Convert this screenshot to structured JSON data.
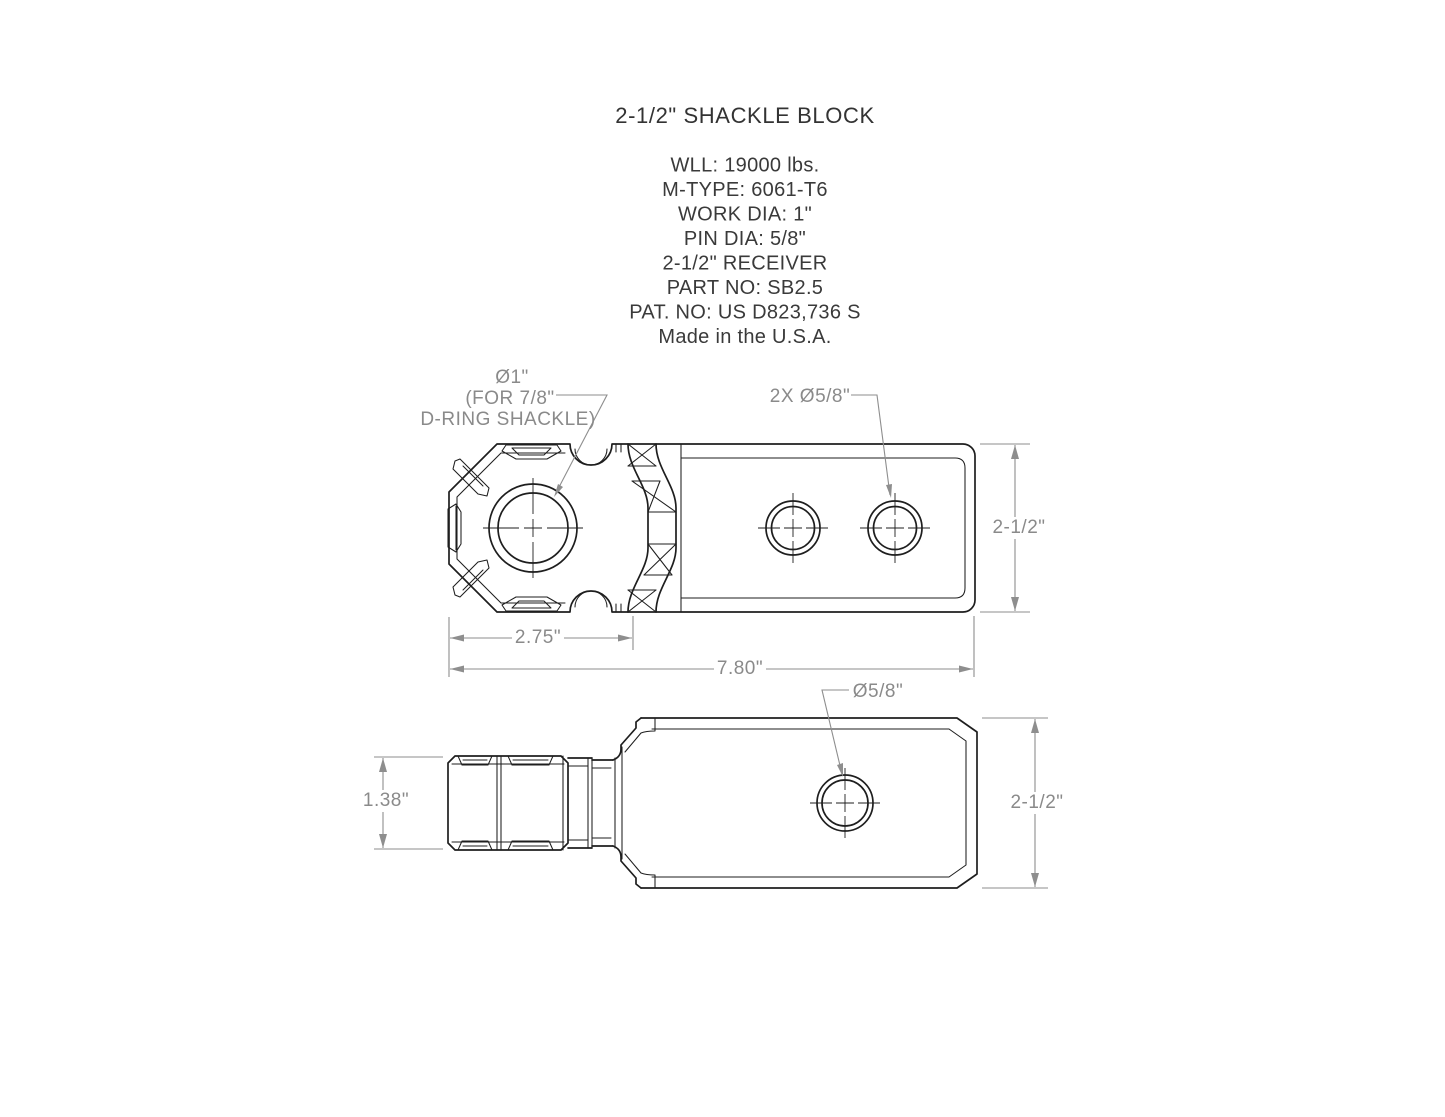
{
  "drawing": {
    "title": "2-1/2\" SHACKLE BLOCK",
    "specs": [
      "WLL: 19000 lbs.",
      "M-TYPE: 6061-T6",
      "WORK DIA: 1\"",
      "PIN DIA: 5/8\"",
      "2-1/2\" RECEIVER",
      "PART NO: SB2.5",
      "PAT. NO: US D823,736 S",
      "Made in the U.S.A."
    ]
  },
  "top_view": {
    "main_hole_label_line1": "Ø1\"",
    "main_hole_label_line2": "(FOR 7/8\"",
    "main_hole_label_line3": "D-RING SHACKLE)",
    "pin_holes_label": "2X Ø5/8\"",
    "dim_head_width": "2.75\"",
    "dim_overall_length": "7.80\"",
    "dim_height": "2-1/2\""
  },
  "side_view": {
    "pin_hole_label": "Ø5/8\"",
    "dim_head_thickness": "1.38\"",
    "dim_height": "2-1/2\""
  },
  "colors": {
    "line": "#1e1e1e",
    "dimension": "#8e8e8e",
    "text": "#3a3a3a",
    "background": "#ffffff"
  }
}
